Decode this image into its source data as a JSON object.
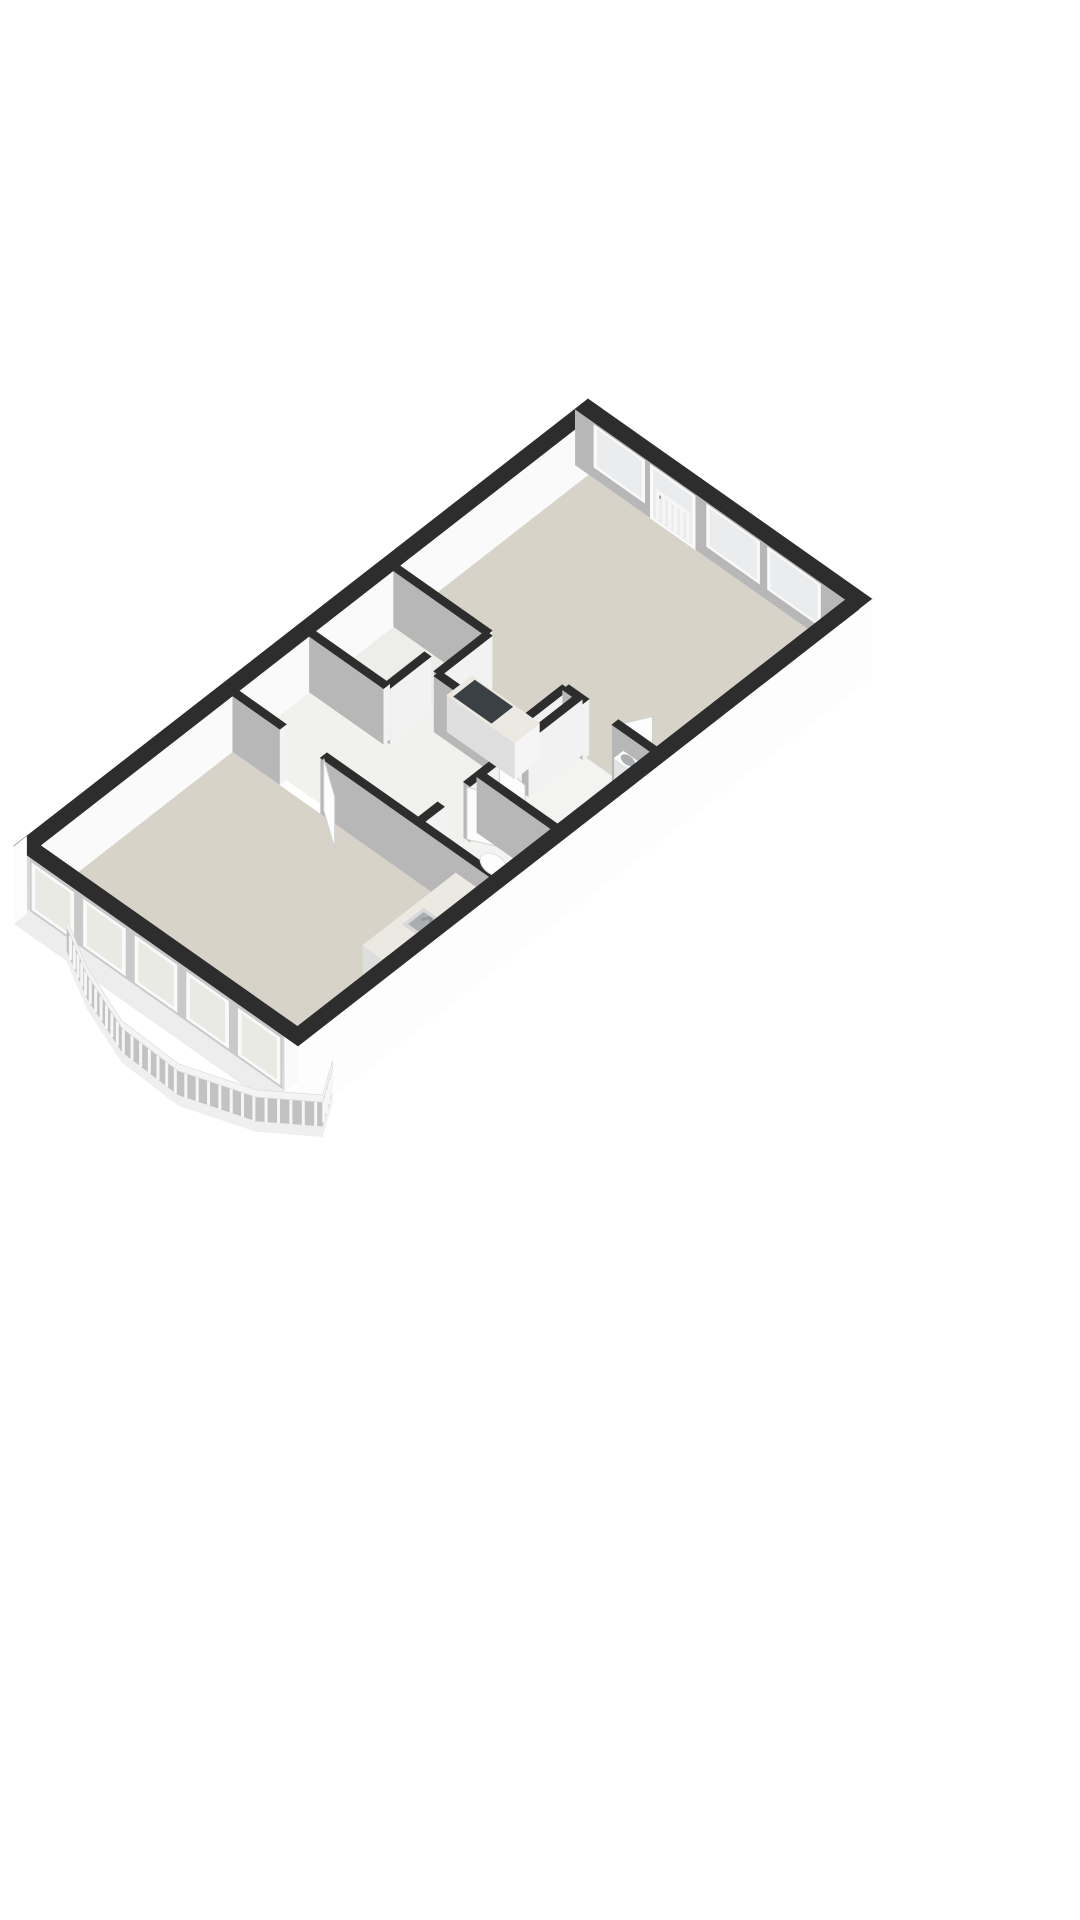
{
  "page": {
    "background": "#ffffff",
    "kind": "3d-floorplan-render"
  },
  "palette": {
    "wallTop": "#2d2d2d",
    "faceNW": "#fcfcfc",
    "faceNE": "#e9e9e9",
    "faceSE": "#f2f2f2",
    "faceSW": "#b7b7b7",
    "exteriorWhite": "#fdfdfd",
    "innerWhite": "#fafafa",
    "floorLiving": "#d7d3c8",
    "floorHall": "#f1f1ee",
    "floorBath": "#f3f3f1",
    "floorStorage": "#ededea",
    "glass": "#eaecee",
    "glassSW": "#eaeae4",
    "frame": "#fafafa",
    "windowBacking": "#c9c9c9",
    "sillFace": "#ededed",
    "endPost": "#d9d9d9",
    "counterTop": "#ece9e3",
    "counterFaceSE": "#f5f5f5",
    "counterFaceSW": "#dedede",
    "counterFaceNE": "#e9e9e9",
    "cooktop": "#3b4044",
    "fixtureWhite": "#fdfdfd",
    "fixtureShade": "#e3e3e3",
    "basin": "#aaaeb1",
    "sinkRim": "#d6d8da",
    "metal": "#93989c",
    "railBand": "#f4f4f4",
    "railBacking": "#c2c2c2",
    "railPicket": "#f6f6f6",
    "railBase": "#efefef",
    "doorLeaf": "#fdfdfd",
    "doorEdge": "#cfcfcf"
  },
  "building": {
    "length_m": 13.3,
    "width_m": 6.3,
    "wall_height_m": 1.4,
    "exterior_wall_thickness_m": 0.3,
    "interior_wall_thickness_m": 0.15,
    "skirt_depth_m": 0.55
  },
  "rooms": [
    {
      "id": "living-sw",
      "floor": "floorLiving",
      "poly": [
        [
          0.3,
          0.3
        ],
        [
          4.75,
          0.3
        ],
        [
          4.75,
          6.0
        ],
        [
          0.3,
          6.0
        ]
      ]
    },
    {
      "id": "hall",
      "floor": "floorHall",
      "poly": [
        [
          4.9,
          0.3
        ],
        [
          6.6,
          0.3
        ],
        [
          6.6,
          1.95
        ],
        [
          8.55,
          1.95
        ],
        [
          8.55,
          2.35
        ],
        [
          7.35,
          2.35
        ],
        [
          7.35,
          4.05
        ],
        [
          8.55,
          4.05
        ],
        [
          8.55,
          4.35
        ],
        [
          4.9,
          4.35
        ]
      ]
    },
    {
      "id": "storage",
      "floor": "floorStorage",
      "poly": [
        [
          6.6,
          0.3
        ],
        [
          8.55,
          0.3
        ],
        [
          8.55,
          1.95
        ],
        [
          6.6,
          1.95
        ]
      ]
    },
    {
      "id": "wc",
      "floor": "floorBath",
      "poly": [
        [
          4.9,
          4.35
        ],
        [
          6.25,
          4.35
        ],
        [
          6.25,
          6.0
        ],
        [
          4.9,
          6.0
        ]
      ]
    },
    {
      "id": "bathroom",
      "floor": "floorBath",
      "poly": [
        [
          6.25,
          4.35
        ],
        [
          8.55,
          4.35
        ],
        [
          8.55,
          6.0
        ],
        [
          6.25,
          6.0
        ]
      ]
    },
    {
      "id": "living-ne",
      "floor": "floorLiving",
      "poly": [
        [
          8.55,
          0.3
        ],
        [
          13.0,
          0.3
        ],
        [
          13.0,
          6.0
        ],
        [
          8.55,
          6.0
        ],
        [
          8.55,
          4.05
        ],
        [
          7.35,
          4.05
        ],
        [
          7.35,
          2.35
        ],
        [
          8.55,
          2.35
        ]
      ]
    }
  ],
  "interior_walls": [
    {
      "id": "storage-se",
      "a1": 6.6,
      "b1": 1.95,
      "a2": 8.55,
      "b2": 1.95,
      "openings": [
        [
          7.55,
          8.15
        ]
      ]
    },
    {
      "id": "storage-sw",
      "a1": 6.6,
      "b1": 0.3,
      "a2": 6.6,
      "b2": 1.95,
      "openings": []
    },
    {
      "id": "livingne-sw-upper",
      "a1": 8.55,
      "b1": 0.3,
      "a2": 8.55,
      "b2": 2.35,
      "openings": []
    },
    {
      "id": "notch-nw",
      "a1": 7.35,
      "b1": 2.35,
      "a2": 8.55,
      "b2": 2.35,
      "openings": []
    },
    {
      "id": "notch-sw",
      "a1": 7.35,
      "b1": 2.35,
      "a2": 7.35,
      "b2": 4.05,
      "openings": []
    },
    {
      "id": "notch-se",
      "a1": 7.35,
      "b1": 4.05,
      "a2": 8.55,
      "b2": 4.05,
      "openings": []
    },
    {
      "id": "livingne-sw-lower",
      "a1": 8.55,
      "b1": 4.05,
      "a2": 8.55,
      "b2": 6.0,
      "openings": [
        [
          4.5,
          5.15
        ]
      ]
    },
    {
      "id": "hall-se",
      "a1": 4.9,
      "b1": 4.35,
      "a2": 8.55,
      "b2": 4.35,
      "openings": [
        [
          5.35,
          5.95
        ],
        [
          6.7,
          7.3
        ]
      ]
    },
    {
      "id": "wc-bath-divider",
      "a1": 6.25,
      "b1": 4.35,
      "a2": 6.25,
      "b2": 6.0,
      "openings": []
    },
    {
      "id": "livingsw-ne",
      "a1": 4.825,
      "b1": 0.3,
      "a2": 4.825,
      "b2": 6.0,
      "openings": [
        [
          1.35,
          2.25
        ]
      ]
    }
  ],
  "ne_openings": [
    {
      "type": "window",
      "b1": 0.5,
      "b2": 1.5
    },
    {
      "type": "balcony-door",
      "b1": 1.75,
      "b2": 2.62,
      "pickets": 6
    },
    {
      "type": "window",
      "b1": 3.0,
      "b2": 4.05
    },
    {
      "type": "window",
      "b1": 4.35,
      "b2": 5.4
    }
  ],
  "sw_window_band": {
    "b1": 0.35,
    "b2": 5.95,
    "sections": 5,
    "mullion_m": 0.12,
    "sill_z": 0.05,
    "top_z": 1.4
  },
  "balcony": {
    "path": [
      [
        0.02,
        1.15
      ],
      [
        -0.5,
        2.1
      ],
      [
        -0.95,
        3.3
      ],
      [
        -1.0,
        4.6
      ],
      [
        -0.55,
        5.9
      ],
      [
        0.1,
        6.75
      ],
      [
        0.75,
        6.35
      ]
    ],
    "picket_spacing_m": 0.2,
    "band_top_z": 0.45,
    "band_bot_z": 0.27,
    "picket_bot_z": -0.34,
    "base_bot_z": -0.6
  },
  "fixtures": {
    "kitchen_counter_sw": {
      "a1": 2.6,
      "b1": 5.25,
      "a2": 4.75,
      "b2": 5.95,
      "h": 0.9
    },
    "sink_sw": {
      "a1": 3.35,
      "b1": 5.4,
      "a2": 3.85,
      "b2": 5.8,
      "faucet": [
        3.62,
        5.78
      ]
    },
    "kitchen_block_ne": {
      "a1": 7.42,
      "b1": 2.5,
      "a2": 8.0,
      "b2": 4.0,
      "h": 0.92
    },
    "cooktop": {
      "a1": 7.46,
      "b1": 2.6,
      "a2": 7.96,
      "b2": 3.45
    },
    "toilet": {
      "tank": [
        5.45,
        5.55,
        5.78,
        5.78
      ],
      "tank_h": 0.62,
      "bowl": [
        5.6,
        5.28
      ],
      "bowl_h": 0.42
    },
    "bath_sink": {
      "a1": 8.32,
      "b1": 5.35,
      "a2": 8.53,
      "b2": 5.75,
      "h": 0.85
    }
  },
  "doors": [
    {
      "id": "door-living-sw",
      "hinge": [
        4.825,
        2.25
      ],
      "end": [
        4.35,
        2.95
      ]
    },
    {
      "id": "door-wc",
      "hinge": [
        5.95,
        4.35
      ],
      "end": [
        6.22,
        4.9
      ]
    },
    {
      "id": "door-bathroom",
      "hinge": [
        6.7,
        4.35
      ],
      "end": [
        6.62,
        5.0
      ]
    },
    {
      "id": "door-storage",
      "hinge": [
        8.15,
        1.95
      ],
      "end": [
        8.5,
        2.45
      ]
    },
    {
      "id": "door-livingne-bath",
      "hinge": [
        8.55,
        5.15
      ],
      "end": [
        9.1,
        5.45
      ]
    }
  ]
}
